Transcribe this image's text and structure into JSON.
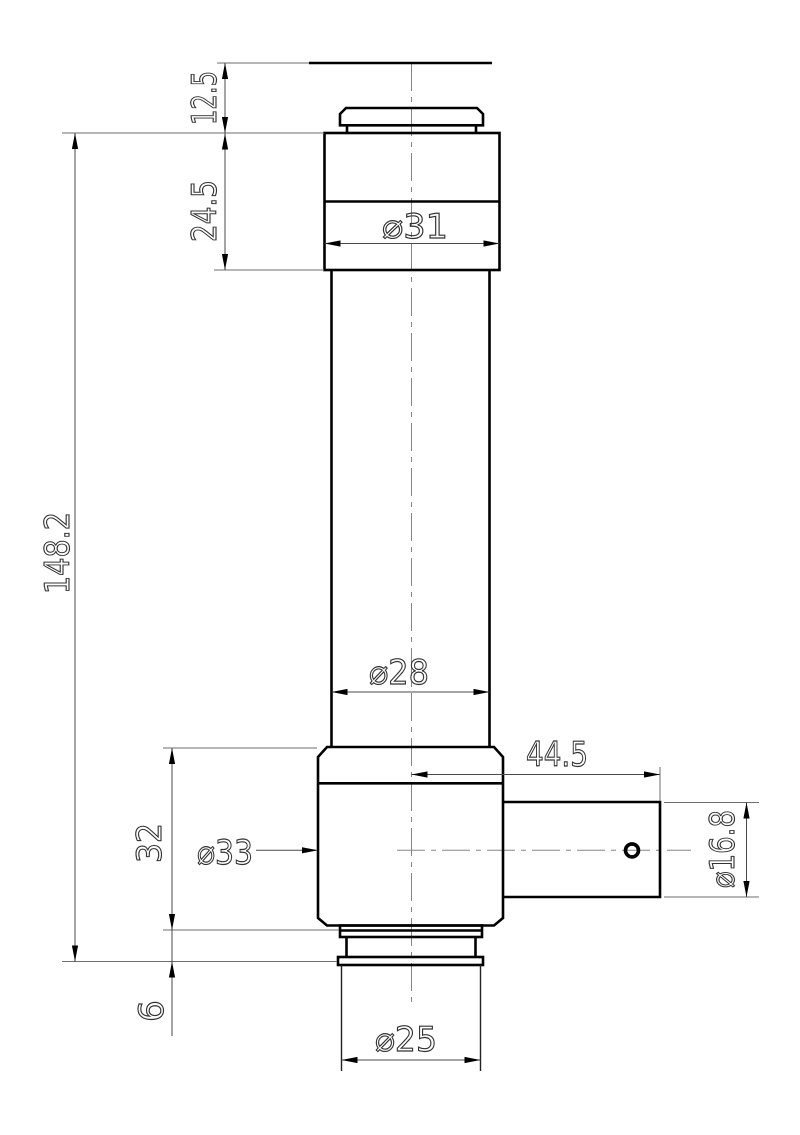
{
  "drawing": {
    "background": "#ffffff",
    "ink_color": "#000000",
    "dimensions": {
      "cap_height": "12.5",
      "head_height": "24.5",
      "head_diameter": "⌀31",
      "overall_length": "148.2",
      "body_diameter": "⌀28",
      "side_arm_length": "44.5",
      "base_height": "32",
      "base_diameter": "⌀33",
      "side_arm_diameter": "⌀16.8",
      "bottom_step_height": "6",
      "bottom_barrel_diameter": "⌀25"
    }
  }
}
